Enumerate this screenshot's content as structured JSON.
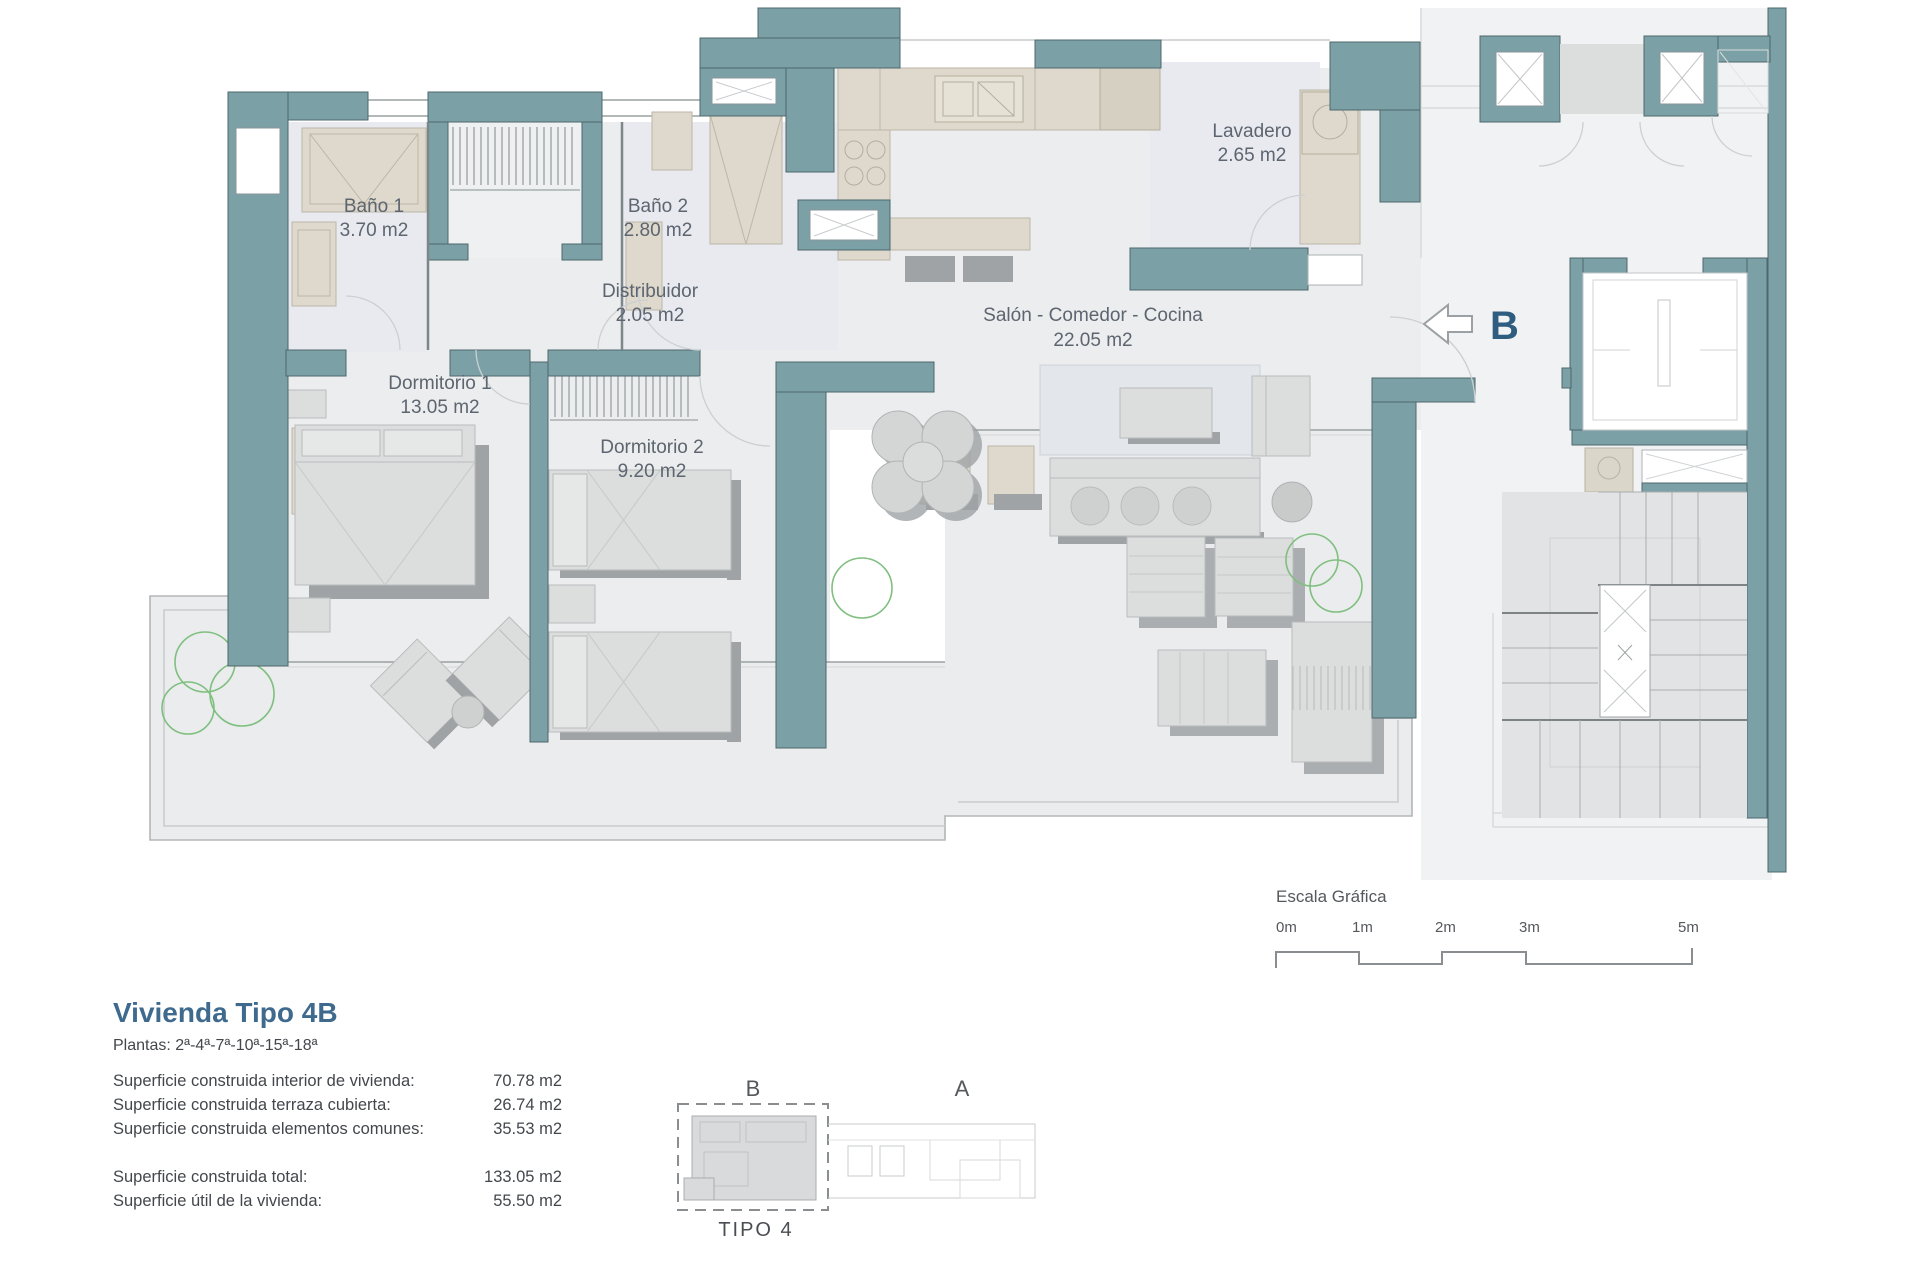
{
  "plan": {
    "rooms": [
      {
        "name": "Baño 1",
        "area": "3.70 m2"
      },
      {
        "name": "Baño 2",
        "area": "2.80 m2"
      },
      {
        "name": "Distribuidor",
        "area": "2.05 m2"
      },
      {
        "name": "Lavadero",
        "area": "2.65 m2"
      },
      {
        "name": "Salón - Comedor - Cocina",
        "area": "22.05 m2"
      },
      {
        "name": "Dormitorio 1",
        "area": "13.05 m2"
      },
      {
        "name": "Dormitorio 2",
        "area": "9.20 m2"
      }
    ],
    "nav": {
      "letter": "B",
      "direction": "left"
    },
    "scale": {
      "title": "Escala Gráfica",
      "ticks": [
        "0m",
        "1m",
        "2m",
        "3m",
        "5m"
      ]
    },
    "colors": {
      "wall": "#7ba1a7",
      "accent": "#2e5d80",
      "plant": "#7fbf7f",
      "fixture": "#ded9cc"
    }
  },
  "title_block": {
    "title": "Vivienda Tipo 4B",
    "plantas": "Plantas: 2ª-4ª-7ª-10ª-15ª-18ª",
    "rows": [
      {
        "label": "Superficie construida interior de vivienda:",
        "value": "70.78 m2"
      },
      {
        "label": "Superficie construida terraza cubierta:",
        "value": "26.74 m2"
      },
      {
        "label": "Superficie construida elementos comunes:",
        "value": "35.53 m2"
      }
    ],
    "totals": [
      {
        "label": "Superficie construida total:",
        "value": "133.05 m2"
      },
      {
        "label": "Superficie útil de la vivienda:",
        "value": "55.50 m2"
      }
    ]
  },
  "key_plan": {
    "unit_b": "B",
    "unit_a": "A",
    "caption": "TIPO 4"
  }
}
